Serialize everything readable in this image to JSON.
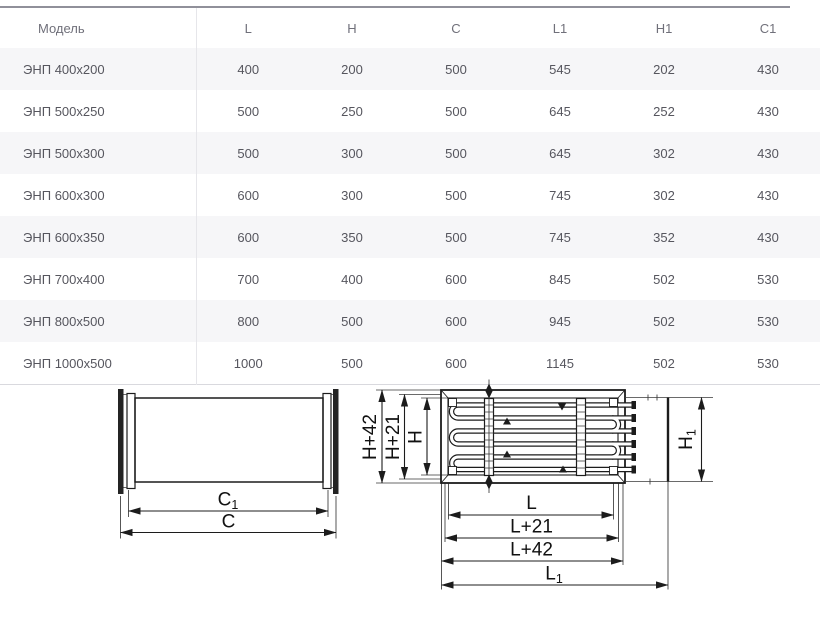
{
  "table": {
    "columns": [
      "Модель",
      "L",
      "H",
      "C",
      "L1",
      "H1",
      "C1"
    ],
    "rows": [
      [
        "ЭНП 400x200",
        "400",
        "200",
        "500",
        "545",
        "202",
        "430"
      ],
      [
        "ЭНП 500x250",
        "500",
        "250",
        "500",
        "645",
        "252",
        "430"
      ],
      [
        "ЭНП 500x300",
        "500",
        "300",
        "500",
        "645",
        "302",
        "430"
      ],
      [
        "ЭНП 600x300",
        "600",
        "300",
        "500",
        "745",
        "302",
        "430"
      ],
      [
        "ЭНП 600x350",
        "600",
        "350",
        "500",
        "745",
        "352",
        "430"
      ],
      [
        "ЭНП 700x400",
        "700",
        "400",
        "600",
        "845",
        "502",
        "530"
      ],
      [
        "ЭНП 800x500",
        "800",
        "500",
        "600",
        "945",
        "502",
        "530"
      ],
      [
        "ЭНП 1000x500",
        "1000",
        "500",
        "600",
        "1145",
        "502",
        "530"
      ]
    ]
  },
  "diagram_duct": {
    "dim_c1": {
      "main": "C",
      "sub": "1"
    },
    "dim_c": {
      "main": "C"
    }
  },
  "diagram_heater": {
    "dim_h42": "H+42",
    "dim_h21": "H+21",
    "dim_h": "H",
    "dim_h1": {
      "main": "H",
      "sub": "1"
    },
    "dim_l": "L",
    "dim_l21": "L+21",
    "dim_l42": "L+42",
    "dim_l1": {
      "main": "L",
      "sub": "1"
    }
  },
  "colors": {
    "row_stripe": "#f6f6f8",
    "table_top_rule": "#90909a",
    "table_bottom_rule": "#d9d9de",
    "column_divider": "#e6e6ea",
    "text": "#56565e",
    "drawing_line": "#1c1c1c"
  }
}
